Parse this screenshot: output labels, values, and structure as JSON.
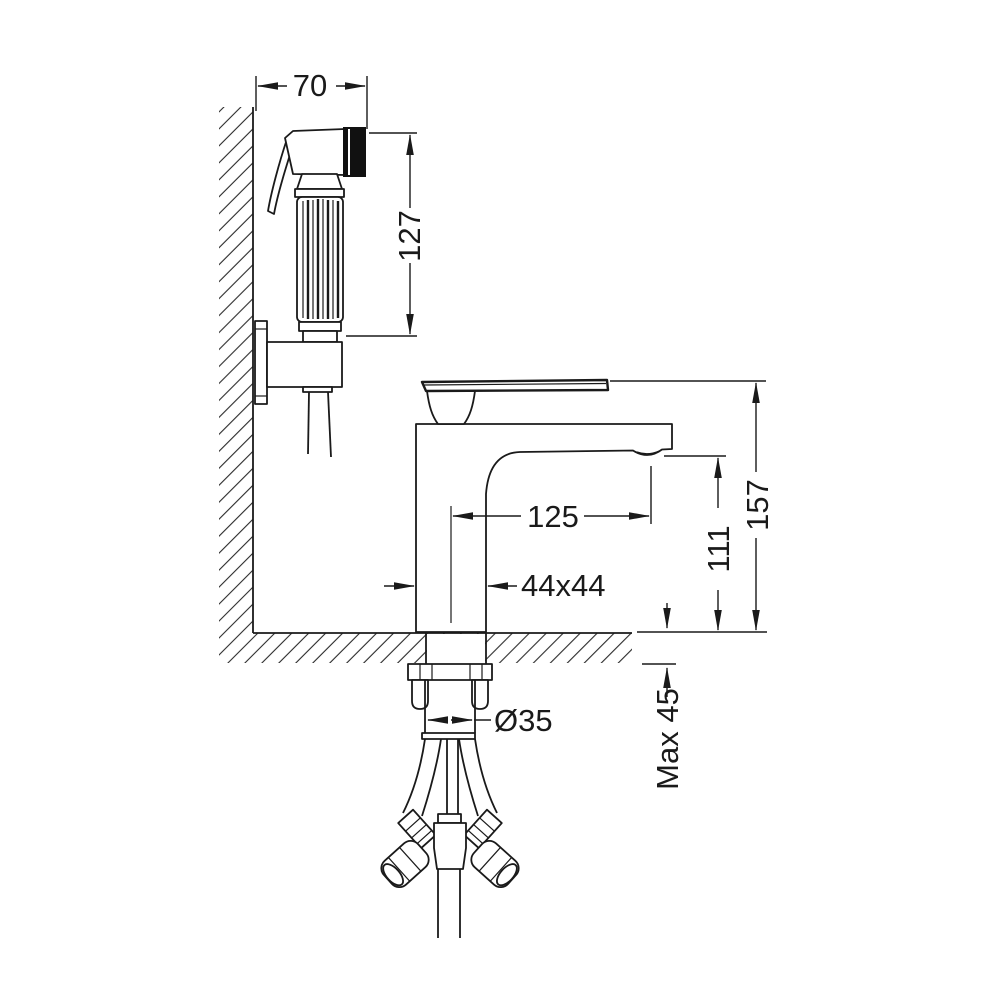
{
  "drawing": {
    "type": "technical-dimension-drawing",
    "colors": {
      "line": "#1a1a1a",
      "background": "#ffffff",
      "spray_face": "#111111"
    },
    "dimensions": {
      "bracket_width": "70",
      "sprayer_height": "127",
      "spout_reach": "125",
      "body_section": "44x44",
      "spout_height": "111",
      "overall_height": "157",
      "hole_diameter": "Ø35",
      "max_counter_thickness": "Max 45"
    }
  }
}
